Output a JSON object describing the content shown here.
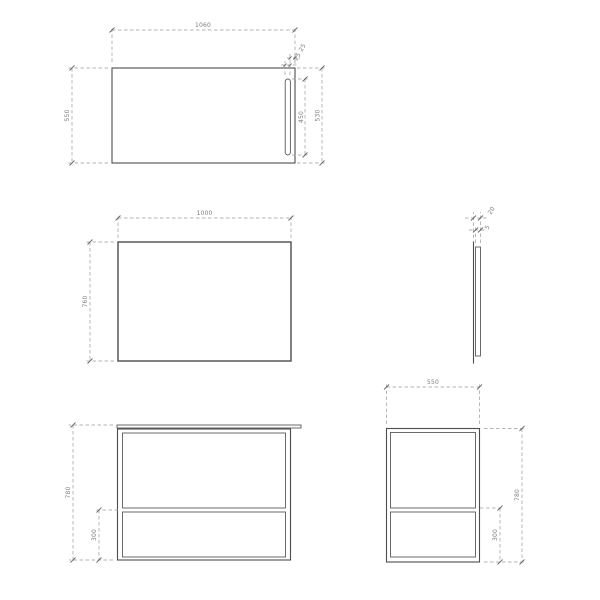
{
  "colors": {
    "background": "#ffffff",
    "main_line": "#4d4d4d",
    "dim_line": "#9a9a9a",
    "dim_text": "#7d7d7d"
  },
  "views": {
    "plan": {
      "dim_width": "1060",
      "dim_depth_left": "550",
      "dim_slot_length": "450",
      "dim_depth_right": "530",
      "dim_slot_offset": "25",
      "dim_slot_width": "25"
    },
    "mirror_front": {
      "dim_width": "1000",
      "dim_height": "760"
    },
    "mirror_side": {
      "dim_total_thickness": "20",
      "dim_panel_thickness": "5"
    },
    "cabinet_front": {
      "dim_height": "780",
      "dim_drawer_height": "300"
    },
    "cabinet_side": {
      "dim_depth": "550",
      "dim_height": "780",
      "dim_drawer_height": "300"
    }
  }
}
